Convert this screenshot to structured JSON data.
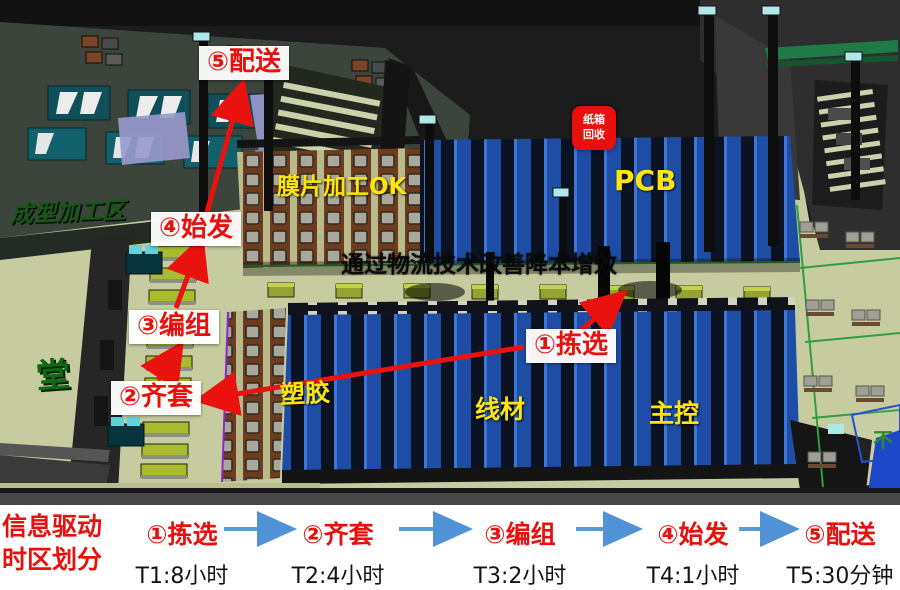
{
  "scene": {
    "banner": "通过物流技术改善降本增效",
    "areas": {
      "film": "膜片加工OK",
      "pcb": "PCB",
      "plastic": "塑胶",
      "wire": "线材",
      "mainctrl": "主控"
    },
    "floor": {
      "molding": "成型加工区",
      "glyph": "堂",
      "corner": "不"
    },
    "recycle": {
      "line1": "纸箱",
      "line2": "回收"
    },
    "ann": {
      "delivery": "⑤配送",
      "depart": "④始发",
      "group": "③编组",
      "kit": "②齐套",
      "pick": "①拣选"
    }
  },
  "flow": {
    "heading1": "信息驱动",
    "heading2": "时区划分",
    "steps": [
      {
        "label": "①拣选",
        "time": "T1:8小时"
      },
      {
        "label": "②齐套",
        "time": "T2:4小时"
      },
      {
        "label": "③编组",
        "time": "T3:2小时"
      },
      {
        "label": "④始发",
        "time": "T4:1小时"
      },
      {
        "label": "⑤配送",
        "time": "T5:30分钟"
      }
    ]
  },
  "colors": {
    "annotation_red": "#e8100c",
    "area_label_yellow": "#ffe60a",
    "flow_arrow_blue": "#5b9bd5",
    "rack_blue": "#1e4da6",
    "floor_green": "#c6cc9f",
    "recycle_red": "#e8100c"
  }
}
